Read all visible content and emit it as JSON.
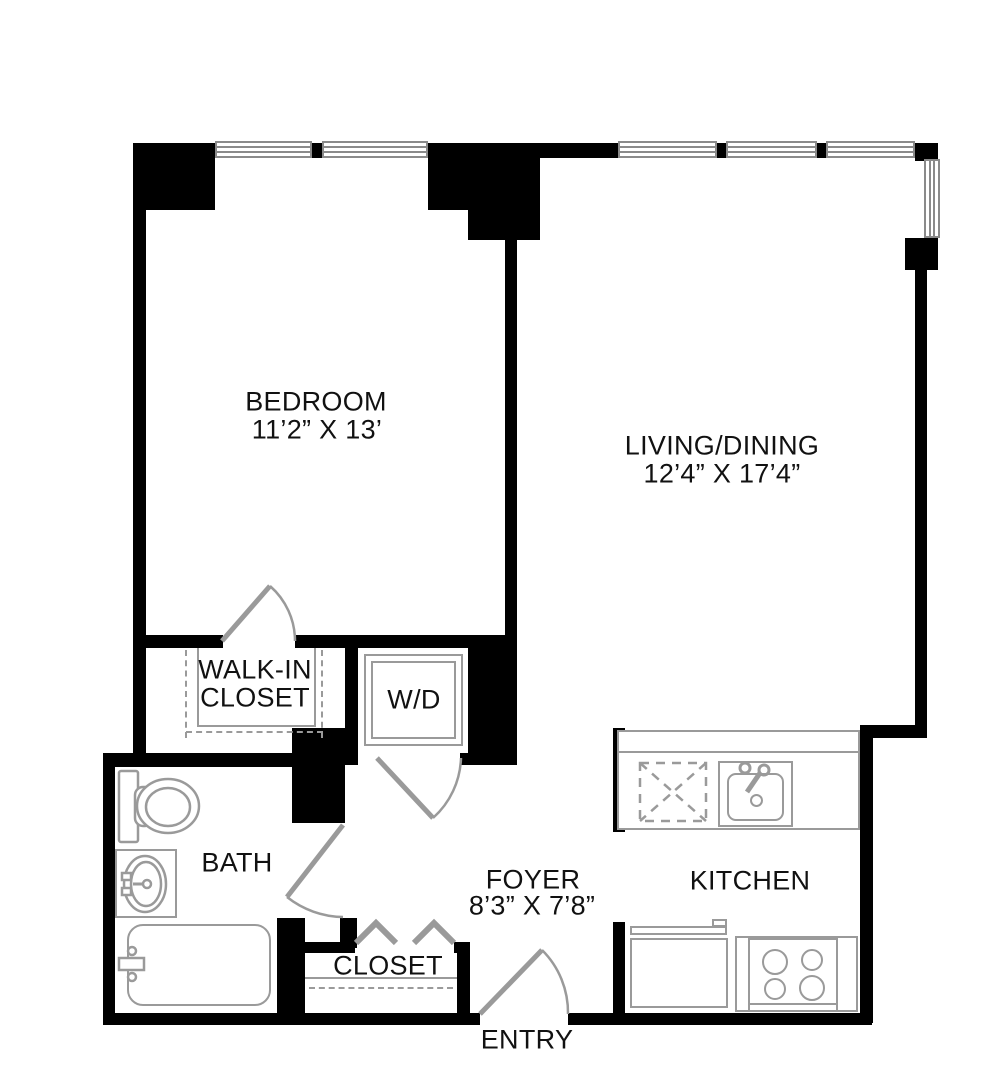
{
  "plan": {
    "bedroom": {
      "label": "BEDROOM",
      "dims": "11’2” X 13’"
    },
    "living_dining": {
      "label": "LIVING/DINING",
      "dims": "12’4” X 17’4”"
    },
    "walk_in_closet": {
      "label_line1": "WALK-IN",
      "label_line2": "CLOSET"
    },
    "washer_dryer": {
      "label": "W/D"
    },
    "bath": {
      "label": "BATH"
    },
    "foyer": {
      "label": "FOYER",
      "dims": "8’3” X 7’8”"
    },
    "kitchen": {
      "label": "KITCHEN"
    },
    "closet": {
      "label": "CLOSET"
    },
    "entry": {
      "label": "ENTRY"
    }
  },
  "colors": {
    "wall": "#000000",
    "fixture": "#9a9a9a",
    "fixture_dark": "#8a8a8a",
    "background": "#ffffff",
    "text": "#111111"
  }
}
